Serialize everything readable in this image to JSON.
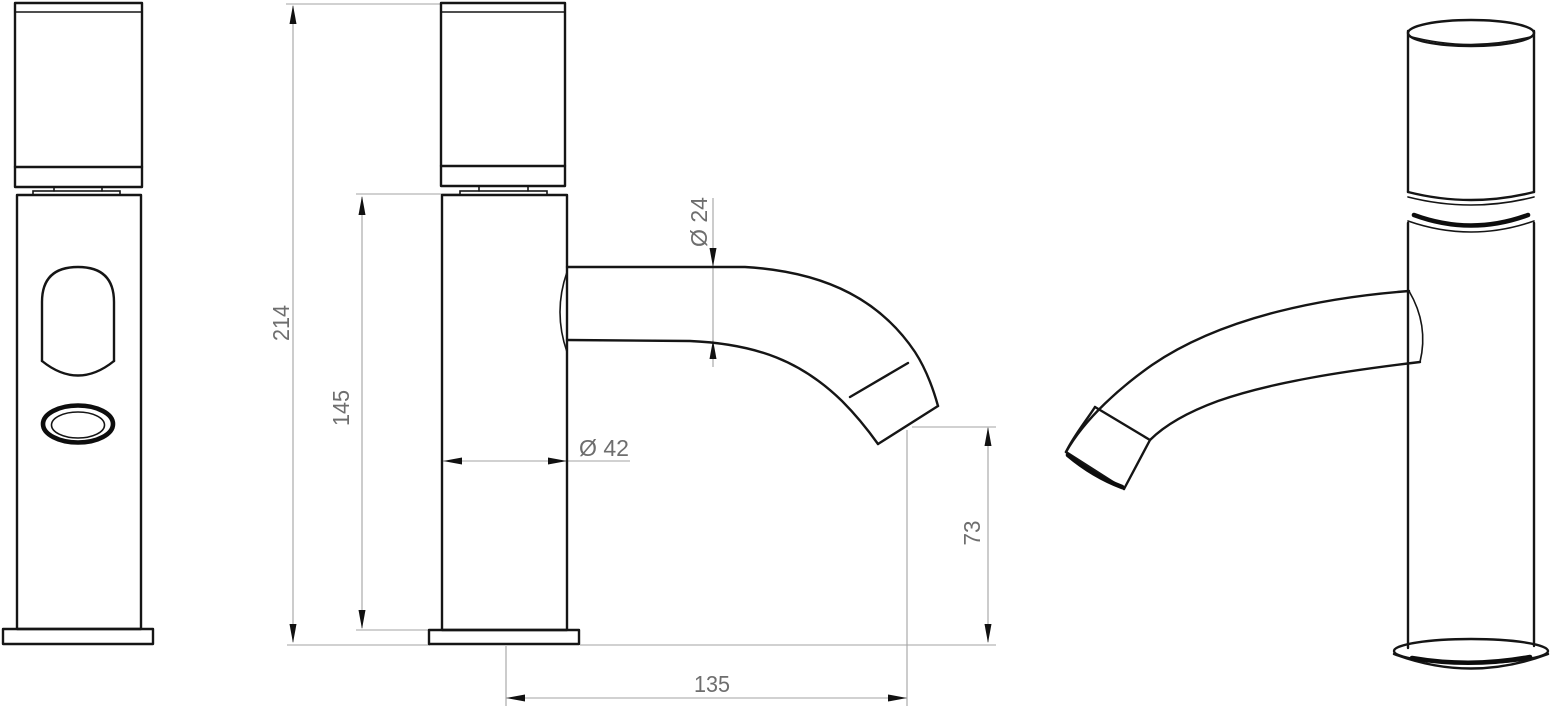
{
  "drawing": {
    "kind": "technical-drawing",
    "subject": "single-lever basin faucet, three views with dimensions",
    "background": "#ffffff",
    "outline_color": "#151515",
    "dimension_line_color": "#a3a3a3",
    "dimension_text_color": "#6e6e6e",
    "dimensions": {
      "total_height": "214",
      "upper_body_height": "145",
      "spout_tube_diameter": "Ø 24",
      "body_diameter": "Ø 42",
      "outlet_clearance_height": "73",
      "spout_reach": "135"
    }
  }
}
